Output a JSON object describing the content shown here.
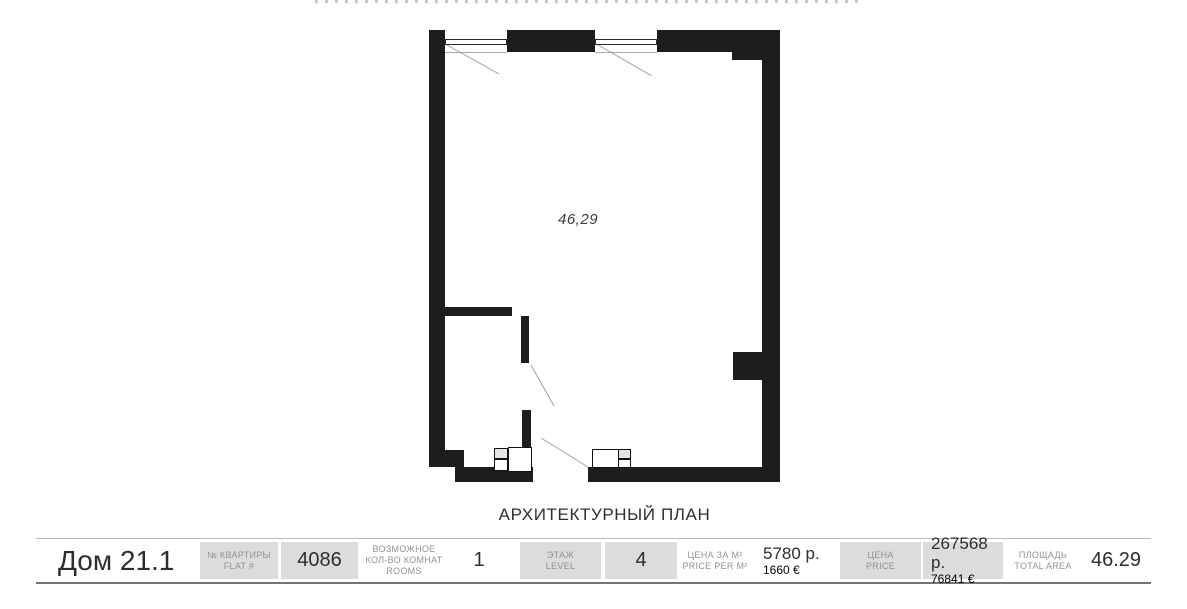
{
  "plan": {
    "area_label": "46,29",
    "caption": "АРХИТЕКТУРНЫЙ ПЛАН"
  },
  "info_bar": {
    "house_title": "Дом 21.1",
    "flat": {
      "label_ru": "№ КВАРТИРЫ",
      "label_en": "FLAT #",
      "value": "4086"
    },
    "rooms": {
      "label_line1": "ВОЗМОЖНОЕ",
      "label_line2": "КОЛ-ВО КОМНАТ",
      "label_line3": "ROOMS",
      "value": "1"
    },
    "level": {
      "label_ru": "ЭТАЖ",
      "label_en": "LEVEL",
      "value": "4"
    },
    "price_per_m2": {
      "label_ru": "ЦЕНА ЗА М²",
      "label_en": "PRICE PER М²",
      "value_rub": "5780 р.",
      "value_eur": "1660 €"
    },
    "price": {
      "label_ru": "ЦЕНА",
      "label_en": "PRICE",
      "value_rub": "267568 р.",
      "value_eur": "76841 €"
    },
    "area": {
      "label_ru": "ПЛОЩАДЬ",
      "label_en": "TOTAL AREA",
      "value": "46.29"
    }
  },
  "colors": {
    "wall_black": "#1d1d1b",
    "box_bg": "#dcdcda",
    "label_gray": "#92928f",
    "value_dark": "#2d2d2d",
    "rule_top": "#b8b8b6",
    "rule_bottom": "#757573",
    "diagonal_gray": "#9f9f9d"
  }
}
